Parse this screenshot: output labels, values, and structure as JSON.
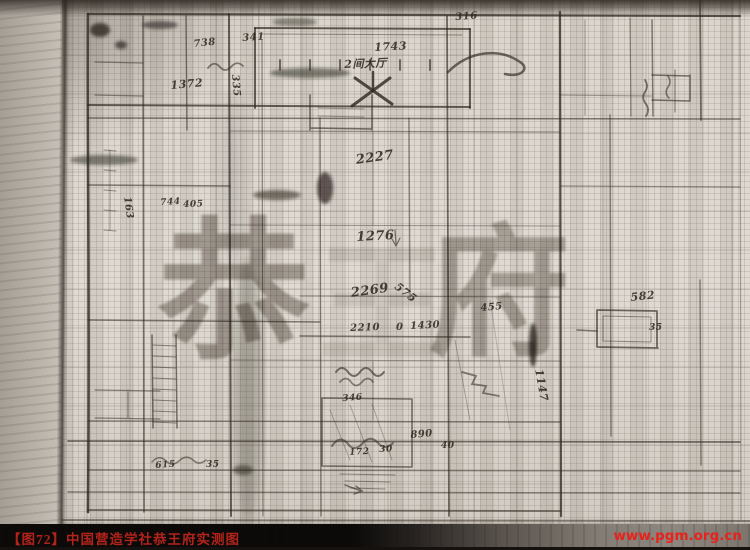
{
  "caption_bar": {
    "figure_label": "【图72】",
    "title": "中国营造学社恭王府实测图",
    "caption_full": "【图72】中国营造学社恭王府实测图",
    "website": "www.pgm.org.cn",
    "caption_color": "#b2231b",
    "url_color": "#e8211a",
    "bar_color": "#0b0a09"
  },
  "watermark": {
    "chars": [
      "恭",
      "王",
      "府"
    ]
  },
  "paper": {
    "base_color": "#ddd8d0",
    "grid_color": "#6c6359",
    "ink_color": "#2e261e"
  },
  "annotations": [
    {
      "t": "738",
      "x": 193,
      "y": 39,
      "s": 10,
      "r": -6
    },
    {
      "t": "341",
      "x": 242,
      "y": 33,
      "s": 10,
      "r": -4
    },
    {
      "t": "1372",
      "x": 170,
      "y": 79,
      "s": 11,
      "r": -5
    },
    {
      "t": "335",
      "x": 240,
      "y": 74,
      "s": 10,
      "r": 85
    },
    {
      "t": "1743",
      "x": 374,
      "y": 41,
      "s": 11,
      "r": -3
    },
    {
      "t": "2间大厅",
      "x": 344,
      "y": 56,
      "s": 11,
      "r": -2
    },
    {
      "t": "316",
      "x": 455,
      "y": 12,
      "s": 10,
      "r": -4
    },
    {
      "t": "2227",
      "x": 355,
      "y": 153,
      "s": 13,
      "r": -8
    },
    {
      "t": "1276",
      "x": 356,
      "y": 230,
      "s": 13,
      "r": -3
    },
    {
      "t": "2269",
      "x": 350,
      "y": 286,
      "s": 13,
      "r": -8
    },
    {
      "t": "575",
      "x": 400,
      "y": 280,
      "s": 11,
      "r": 38
    },
    {
      "t": "455",
      "x": 480,
      "y": 303,
      "s": 10,
      "r": -5
    },
    {
      "t": "2210",
      "x": 350,
      "y": 323,
      "s": 10,
      "r": -2
    },
    {
      "t": "0",
      "x": 396,
      "y": 322,
      "s": 10,
      "r": 0
    },
    {
      "t": "1430",
      "x": 410,
      "y": 321,
      "s": 10,
      "r": -3
    },
    {
      "t": "582",
      "x": 630,
      "y": 291,
      "s": 11,
      "r": -6
    },
    {
      "t": "35",
      "x": 649,
      "y": 323,
      "s": 9,
      "r": 0
    },
    {
      "t": "1147",
      "x": 545,
      "y": 368,
      "s": 11,
      "r": 80
    },
    {
      "t": "346",
      "x": 342,
      "y": 394,
      "s": 9,
      "r": -4
    },
    {
      "t": "890",
      "x": 410,
      "y": 430,
      "s": 10,
      "r": -5
    },
    {
      "t": "40",
      "x": 441,
      "y": 441,
      "s": 9,
      "r": 0
    },
    {
      "t": "30",
      "x": 379,
      "y": 445,
      "s": 9,
      "r": -3
    },
    {
      "t": "172",
      "x": 349,
      "y": 448,
      "s": 9,
      "r": -3
    },
    {
      "t": "615",
      "x": 155,
      "y": 461,
      "s": 9,
      "r": -4
    },
    {
      "t": "35",
      "x": 206,
      "y": 460,
      "s": 9,
      "r": 0
    },
    {
      "t": "163",
      "x": 132,
      "y": 196,
      "s": 10,
      "r": 82
    },
    {
      "t": "744",
      "x": 160,
      "y": 198,
      "s": 9,
      "r": -3
    },
    {
      "t": "405",
      "x": 183,
      "y": 200,
      "s": 9,
      "r": -2
    }
  ]
}
